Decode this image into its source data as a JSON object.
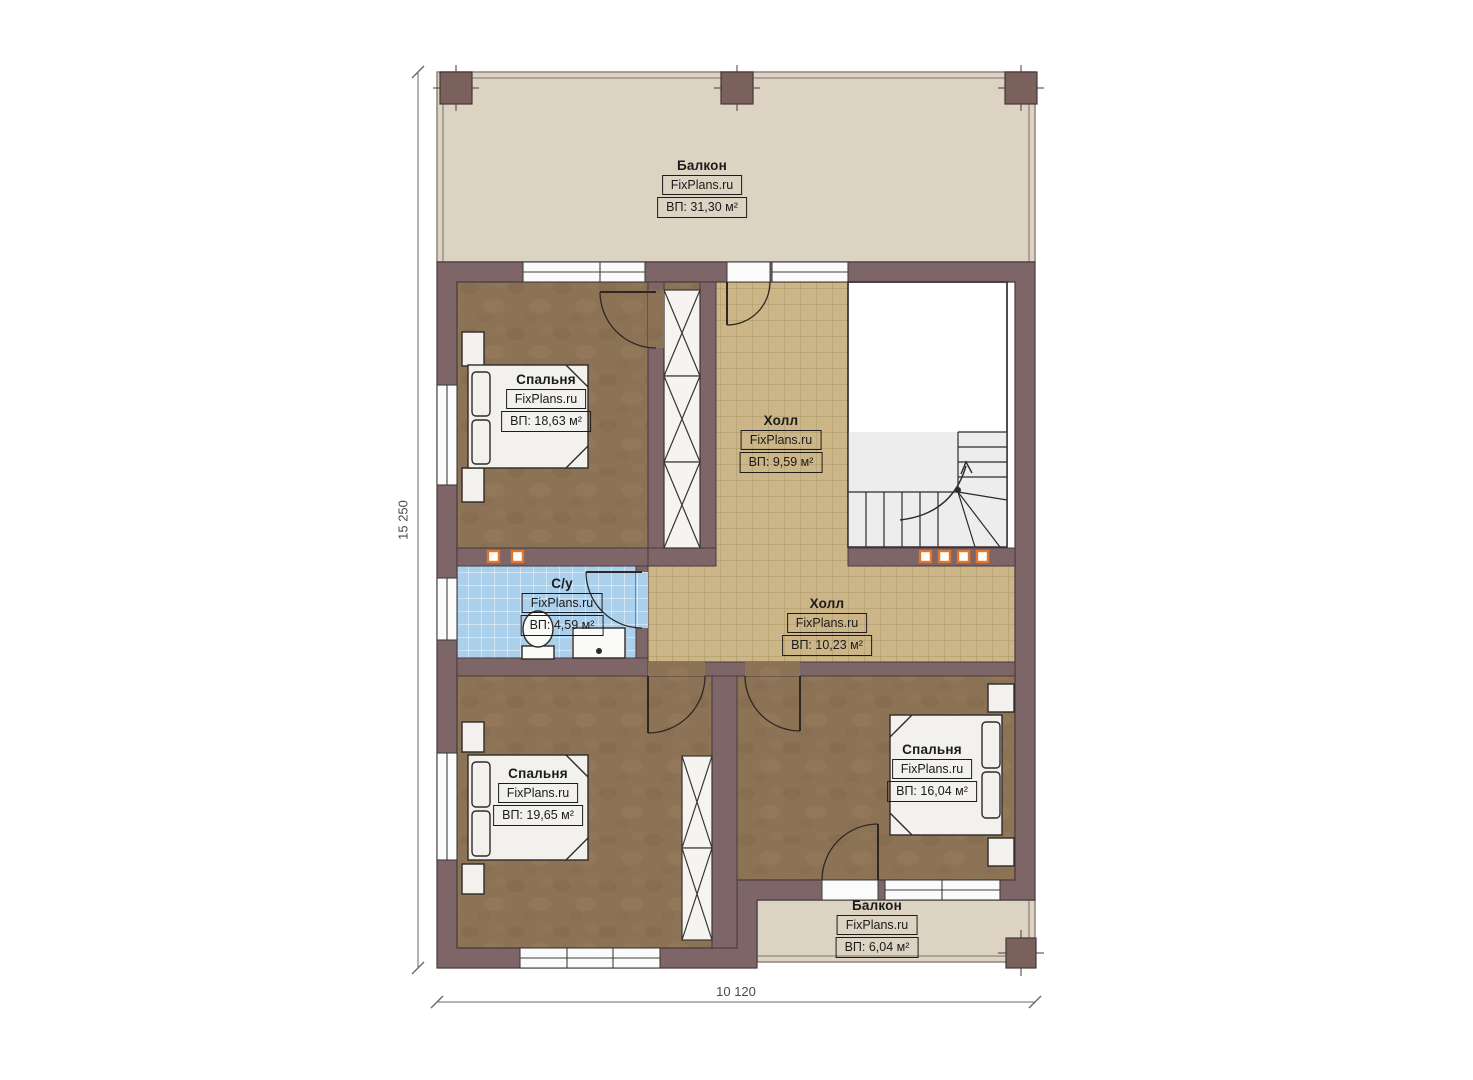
{
  "watermark": "FixPlans.ru",
  "dimensions": {
    "height_label": "15 250",
    "width_label": "10 120"
  },
  "rooms": [
    {
      "id": "balcony-top",
      "name": "Балкон",
      "area": "ВП: 31,30 м²"
    },
    {
      "id": "bedroom-top-left",
      "name": "Спальня",
      "area": "ВП: 18,63 м²"
    },
    {
      "id": "hall-upper",
      "name": "Холл",
      "area": "ВП: 9,59 м²"
    },
    {
      "id": "bathroom",
      "name": "С/у",
      "area": "ВП: 4,59 м²"
    },
    {
      "id": "hall-lower",
      "name": "Холл",
      "area": "ВП: 10,23 м²"
    },
    {
      "id": "bedroom-bottom-left",
      "name": "Спальня",
      "area": "ВП: 19,65 м²"
    },
    {
      "id": "bedroom-right",
      "name": "Спальня",
      "area": "ВП: 16,04 м²"
    },
    {
      "id": "balcony-bottom",
      "name": "Балкон",
      "area": "ВП: 6,04 м²"
    }
  ],
  "colors": {
    "wall": "#7e6568",
    "balcony_floor": "#ddd3c3",
    "hall_tile": "#ccb687",
    "bathroom_tile": "#abd0ec",
    "bedroom_floor": "#8d7355",
    "radiator_accent": "#e2762f"
  }
}
